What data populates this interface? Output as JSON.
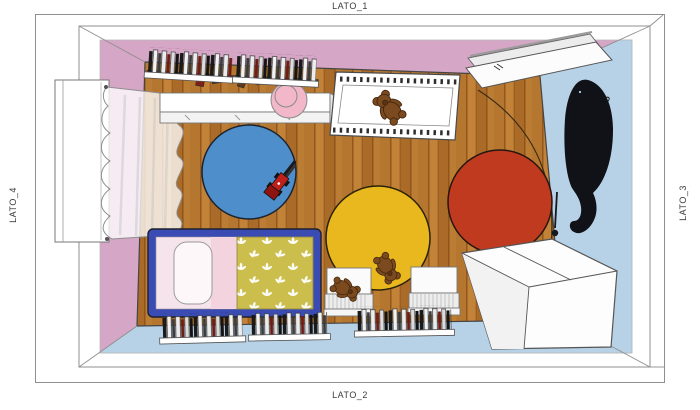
{
  "frame_labels": {
    "top": "LATO_1",
    "bottom": "LATO_2",
    "left": "LATO_4",
    "right": "LATO_3"
  },
  "colors": {
    "wall_pink": "#d6a6c6",
    "wall_blue": "#b7d2e7",
    "floor_wood": "#b2702c",
    "rug_blue": "#4d8ecb",
    "rug_yellow": "#e9b81e",
    "rug_red": "#bf3a1e",
    "bed_frame_blue": "#3a4cb4",
    "duvet_olive": "#ccbe4d",
    "pillow_pink": "#f6e4ec",
    "sheet_pink": "#f3d3de",
    "pouf_pink": "#f2b8c9",
    "bear_brown": "#7b4a1e",
    "whale_black": "#101218",
    "toy_red": "#c0201a",
    "furniture_white": "#fdfdfd",
    "outline_gray": "#8a8a8a"
  },
  "scene": {
    "room": {
      "wall_top": "pink",
      "wall_left": "pink",
      "wall_right": "light-blue",
      "wall_bottom": "light-blue",
      "floor": "wood-planks"
    },
    "objects": [
      "window",
      "sheer-curtain",
      "wall-bookshelf-1",
      "wall-bookshelf-2",
      "sideboard",
      "pink-pouf",
      "small-toys",
      "crib",
      "teddy-bear-crib",
      "open-door",
      "door-swing-arc",
      "whale-wall-decal",
      "hanging-ball-decor",
      "blue-round-rug",
      "toy-truck",
      "yellow-round-rug",
      "red-round-rug",
      "bed",
      "pillow",
      "floral-duvet",
      "ottoman-1",
      "ottoman-2",
      "teddy-bear-rug",
      "teddy-bear-ottoman",
      "floor-bookshelf-1",
      "floor-bookshelf-2",
      "floor-bookshelf-3",
      "wardrobe"
    ]
  }
}
